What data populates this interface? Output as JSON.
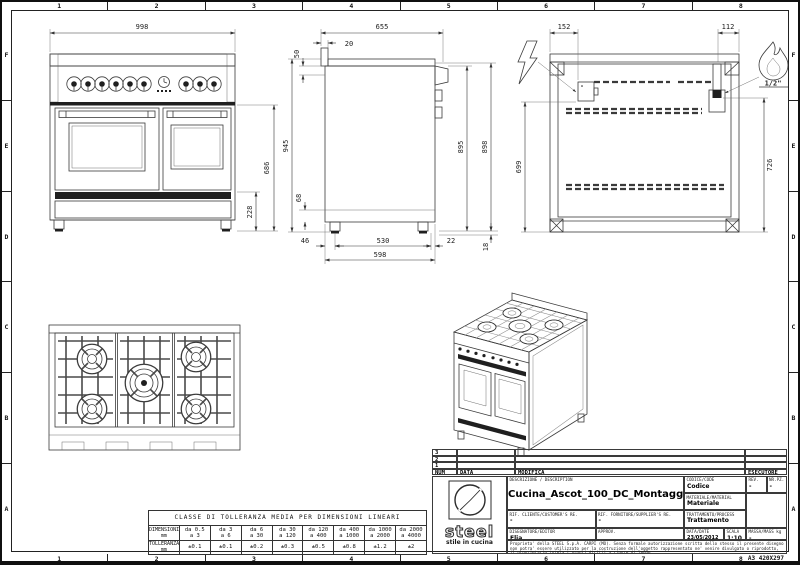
{
  "sheet": {
    "columns": [
      "1",
      "2",
      "3",
      "4",
      "5",
      "6",
      "7",
      "8"
    ],
    "rows": [
      "F",
      "E",
      "D",
      "C",
      "B",
      "A"
    ],
    "format_code": "A3 420X297"
  },
  "dimensions": {
    "front": {
      "width": "998",
      "body_height": "686",
      "base_height": "228"
    },
    "side": {
      "depth": "655",
      "upstand_depth": "20",
      "top_height": "50",
      "total_height": "945",
      "plinth_height": "68",
      "foot_back_offset": "46",
      "foot_spacing": "530",
      "foot_front_offset": "22",
      "base_depth": "598",
      "height_inner": "895",
      "height_outer": "898",
      "foot_height": "18"
    },
    "rear": {
      "electric_offset": "152",
      "gas_offset": "112",
      "electric_height": "699",
      "gas_height": "726",
      "gas_connection": "1/2\""
    }
  },
  "tolerance": {
    "title": "CLASSE DI TOLLERANZA MEDIA PER DIMENSIONI LINEARI",
    "dim_label": "DIMENSIONI",
    "tol_label": "TOLLERANZA",
    "unit": "mm",
    "ranges": [
      [
        "da 0.5",
        "a 3"
      ],
      [
        "da 3",
        "a 6"
      ],
      [
        "da 6",
        "a 30"
      ],
      [
        "da 30",
        "a 120"
      ],
      [
        "da 120",
        "a 400"
      ],
      [
        "da 400",
        "a 1000"
      ],
      [
        "da 1000",
        "a 2000"
      ],
      [
        "da 2000",
        "a 4000"
      ]
    ],
    "values": [
      "±0.1",
      "±0.1",
      "±0.2",
      "±0.3",
      "±0.5",
      "±0.8",
      "±1.2",
      "±2"
    ]
  },
  "title_block": {
    "revisions": {
      "rows": [
        "3",
        "2",
        "1"
      ],
      "num": "NUM",
      "data": "DATA",
      "modifica": "MODIFICA",
      "esecutore": "ESECUTORE"
    },
    "logo": {
      "brand": "steel",
      "tagline": "stile in cucina"
    },
    "description_label": "DESCRIZIONE / DESCRIPTION",
    "description": "Cucina_Ascot_100_DC_Montaggio",
    "codice_label": "CODICE/CODE",
    "codice": "Codice",
    "rev_label": "REV.",
    "rev": "-",
    "nrpz_label": "NR.PZ.",
    "nrpz": "-",
    "materiale_label": "MATERIALE/MATERIAL",
    "materiale": "Materiale",
    "rif_cliente_label": "RIF. CLIENTE/CUSTOMER'S RE.",
    "rif_cliente": "-",
    "rif_fornitore_label": "RIF. FORNITORE/SUPPLIER'S RE.",
    "rif_fornitore": "-",
    "trattamento_label": "TRATTAMENTO/PROCESS",
    "trattamento": "Trattamento",
    "disegnatore_label": "DISEGNATORE/EDITOR",
    "disegnatore": "Elia",
    "approv_label": "APPROV.",
    "approv": "",
    "data_label": "DATA/DATE",
    "data": "23/05/2012",
    "scala_label": "SCALA",
    "scala": "1:10",
    "massa_label": "MASSA/MASS kg",
    "massa": "-",
    "disclaimer": "Proprieta' della STEEL S.p.A. CARPI (MO). Senza formale autorizzazione scritta dello stesso il presente disegno non potra' essere utilizzato per la costruzione dell'oggetto rappresentato ne' venire divulgato o riprodotto, il proprietario tutela i propri diritti a rigore di legge."
  }
}
